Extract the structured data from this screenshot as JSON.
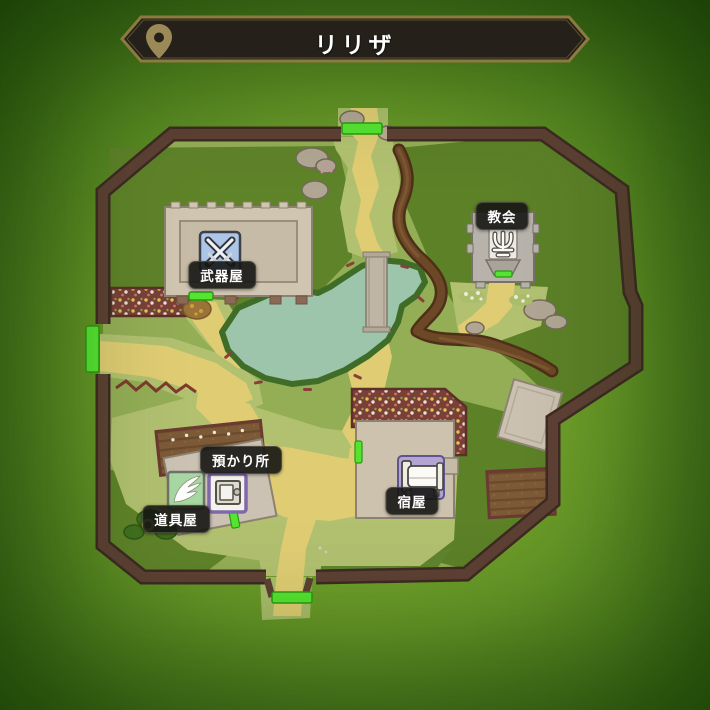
{
  "header": {
    "title": "リリザ",
    "pin_icon": "location-pin"
  },
  "map": {
    "locations": [
      {
        "id": "weapon-shop",
        "label": "武器屋",
        "icon": "crossed-swords-icon"
      },
      {
        "id": "church",
        "label": "教会",
        "icon": "church-symbol-icon"
      },
      {
        "id": "storage",
        "label": "預かり所",
        "icon": "vault-icon"
      },
      {
        "id": "item-shop",
        "label": "道具屋",
        "icon": "wing-icon"
      },
      {
        "id": "inn",
        "label": "宿屋",
        "icon": "bed-icon"
      }
    ],
    "gates": [
      "north-gate",
      "west-gate",
      "south-gate"
    ],
    "colors": {
      "gate_marker": "#55e432",
      "wall": "#5d4034",
      "path": "#e0cd73",
      "pond": "#9cc5ab",
      "grass_light": "#b2c170",
      "grass_base": "#94ae56",
      "grass_dark": "#5f8329",
      "banner_bg": "#25211a",
      "banner_border": "#8d7a40"
    }
  }
}
